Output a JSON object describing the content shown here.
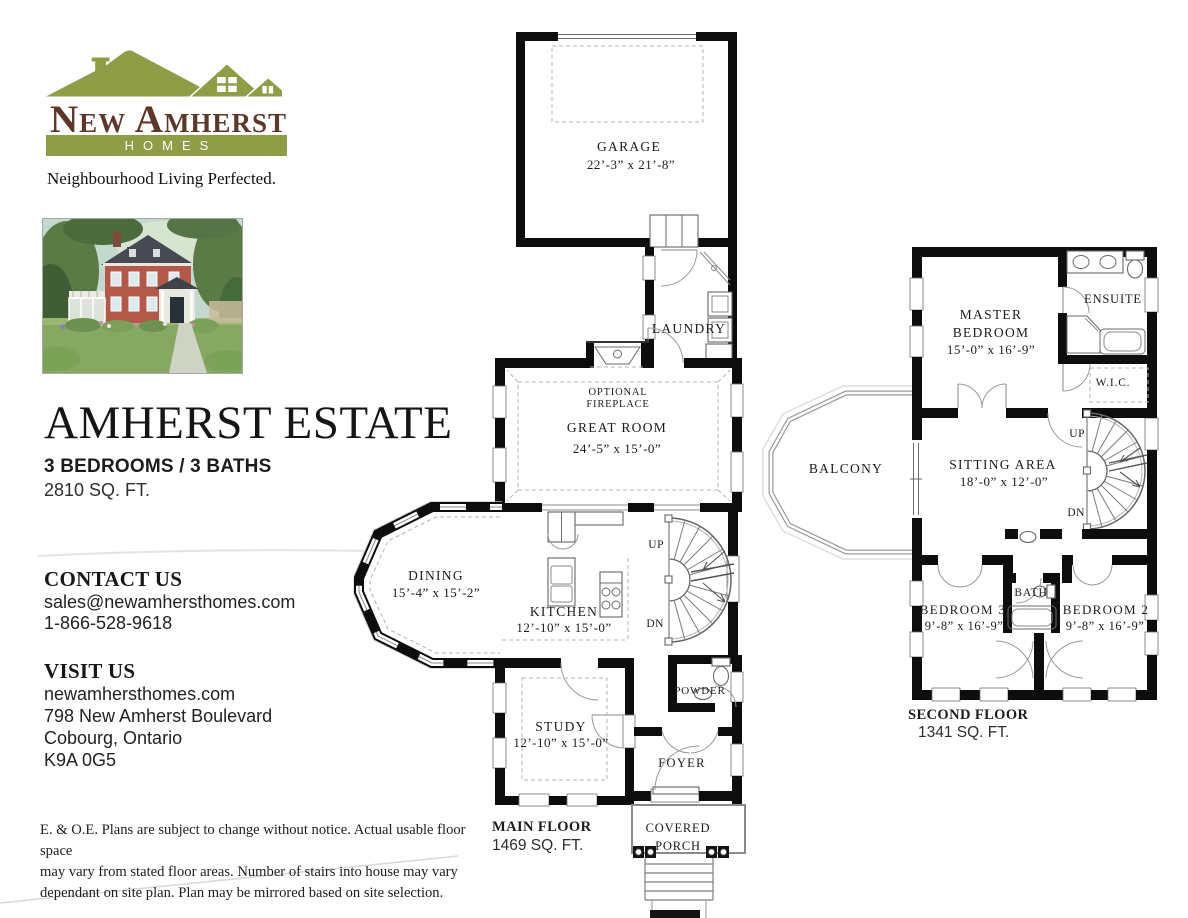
{
  "brand": {
    "name": "New Amherst",
    "homes": "HOMES",
    "tagline": "Neighbourhood Living Perfected.",
    "green": "#8e9d46",
    "brown": "#5d382a"
  },
  "listing": {
    "title": "AMHERST ESTATE",
    "specs": "3 BEDROOMS / 3 BATHS",
    "area": "2810 SQ. FT."
  },
  "contact": {
    "heading": "CONTACT US",
    "email": "sales@newamhersthomes.com",
    "phone": "1-866-528-9618"
  },
  "visit": {
    "heading": "VISIT US",
    "website": "newamhersthomes.com",
    "address": "798 New Amherst Boulevard",
    "city": "Cobourg, Ontario",
    "postal": "K9A 0G5"
  },
  "disclaimer": {
    "l1": "E. & O.E. Plans are subject to change without notice. Actual usable floor space",
    "l2": "may vary from stated floor areas. Number of stairs into house may vary",
    "l3": "dependant on site plan. Plan may be mirrored based on site selection."
  },
  "mf": {
    "garage": "GARAGE",
    "garage_d": "22’-3” x 21’-8”",
    "laundry": "LAUNDRY",
    "opt1": "OPTIONAL",
    "opt2": "FIREPLACE",
    "great": "GREAT ROOM",
    "great_d": "24’-5” x 15’-0”",
    "dining": "DINING",
    "dining_d": "15’-4” x 15’-2”",
    "kitchen": "KITCHEN",
    "kitchen_d": "12’-10” x 15’-0”",
    "study": "STUDY",
    "study_d": "12’-10” x 15’-0”",
    "powder": "POWDER",
    "foyer": "FOYER",
    "porch1": "COVERED",
    "porch2": "PORCH",
    "up": "UP",
    "dn": "DN",
    "label": "MAIN FLOOR",
    "area": "1469 SQ. FT."
  },
  "sf": {
    "master1": "MASTER",
    "master2": "BEDROOM",
    "master_d": "15’-0” x 16’-9”",
    "ensuite": "ENSUITE",
    "wic": "W.I.C.",
    "sitting": "SITTING AREA",
    "sitting_d": "18’-0” x 12’-0”",
    "balcony": "BALCONY",
    "bed3": "BEDROOM 3",
    "bed3_d": "9’-8” x 16’-9”",
    "bath": "BATH",
    "bed2": "BEDROOM 2",
    "bed2_d": "9’-8” x 16’-9”",
    "up": "UP",
    "dn": "DN",
    "label": "SECOND FLOOR",
    "area": "1341 SQ. FT."
  }
}
